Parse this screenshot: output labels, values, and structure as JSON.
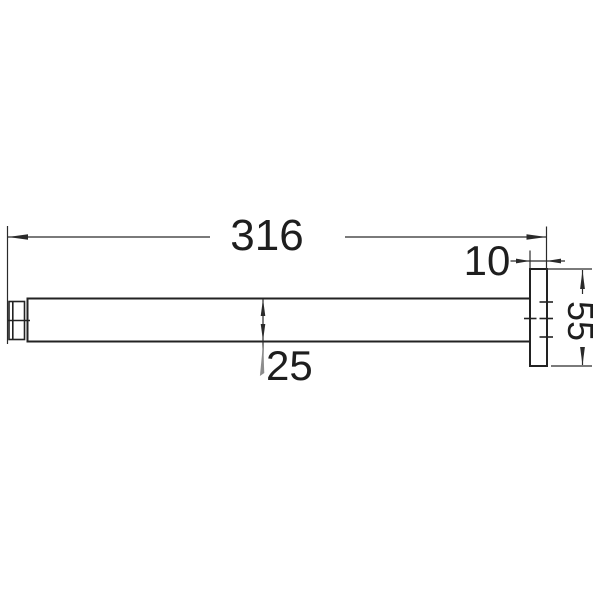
{
  "drawing": {
    "background": "#ffffff",
    "line_color": "#222222",
    "dimensions": {
      "overall_length": {
        "label": "316"
      },
      "flange_depth": {
        "label": "10"
      },
      "flange_diameter": {
        "label": "55"
      },
      "arm_diameter": {
        "label": "25"
      }
    }
  }
}
